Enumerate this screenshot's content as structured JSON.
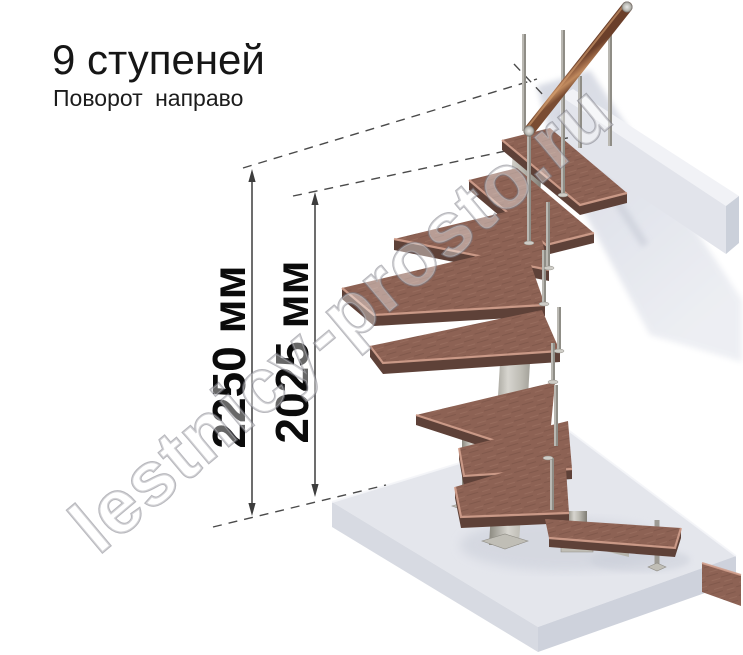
{
  "header": {
    "title": "9 ступеней",
    "subtitle": "Поворот направо"
  },
  "dimensions": {
    "left_label": "2250 мм",
    "right_label": "2025 мм",
    "left_value_mm": 2250,
    "right_value_mm": 2025
  },
  "watermark": {
    "text": "lestnicy-prosto.ru"
  },
  "diagram": {
    "type": "3d-staircase-render",
    "steps_total": 9,
    "turn_direction": "направо",
    "colors": {
      "tread_wood": "#8d6254",
      "tread_nosing": "#d2a08d",
      "tread_underside": "#5e4138",
      "metal": "#bdbbb3",
      "handrail_wood": "#a9734e",
      "floor_slab": "#e4e6ec",
      "dimension_line": "#3d3d3d",
      "text": "#161616",
      "watermark_gray": "#9a9aa2"
    }
  }
}
